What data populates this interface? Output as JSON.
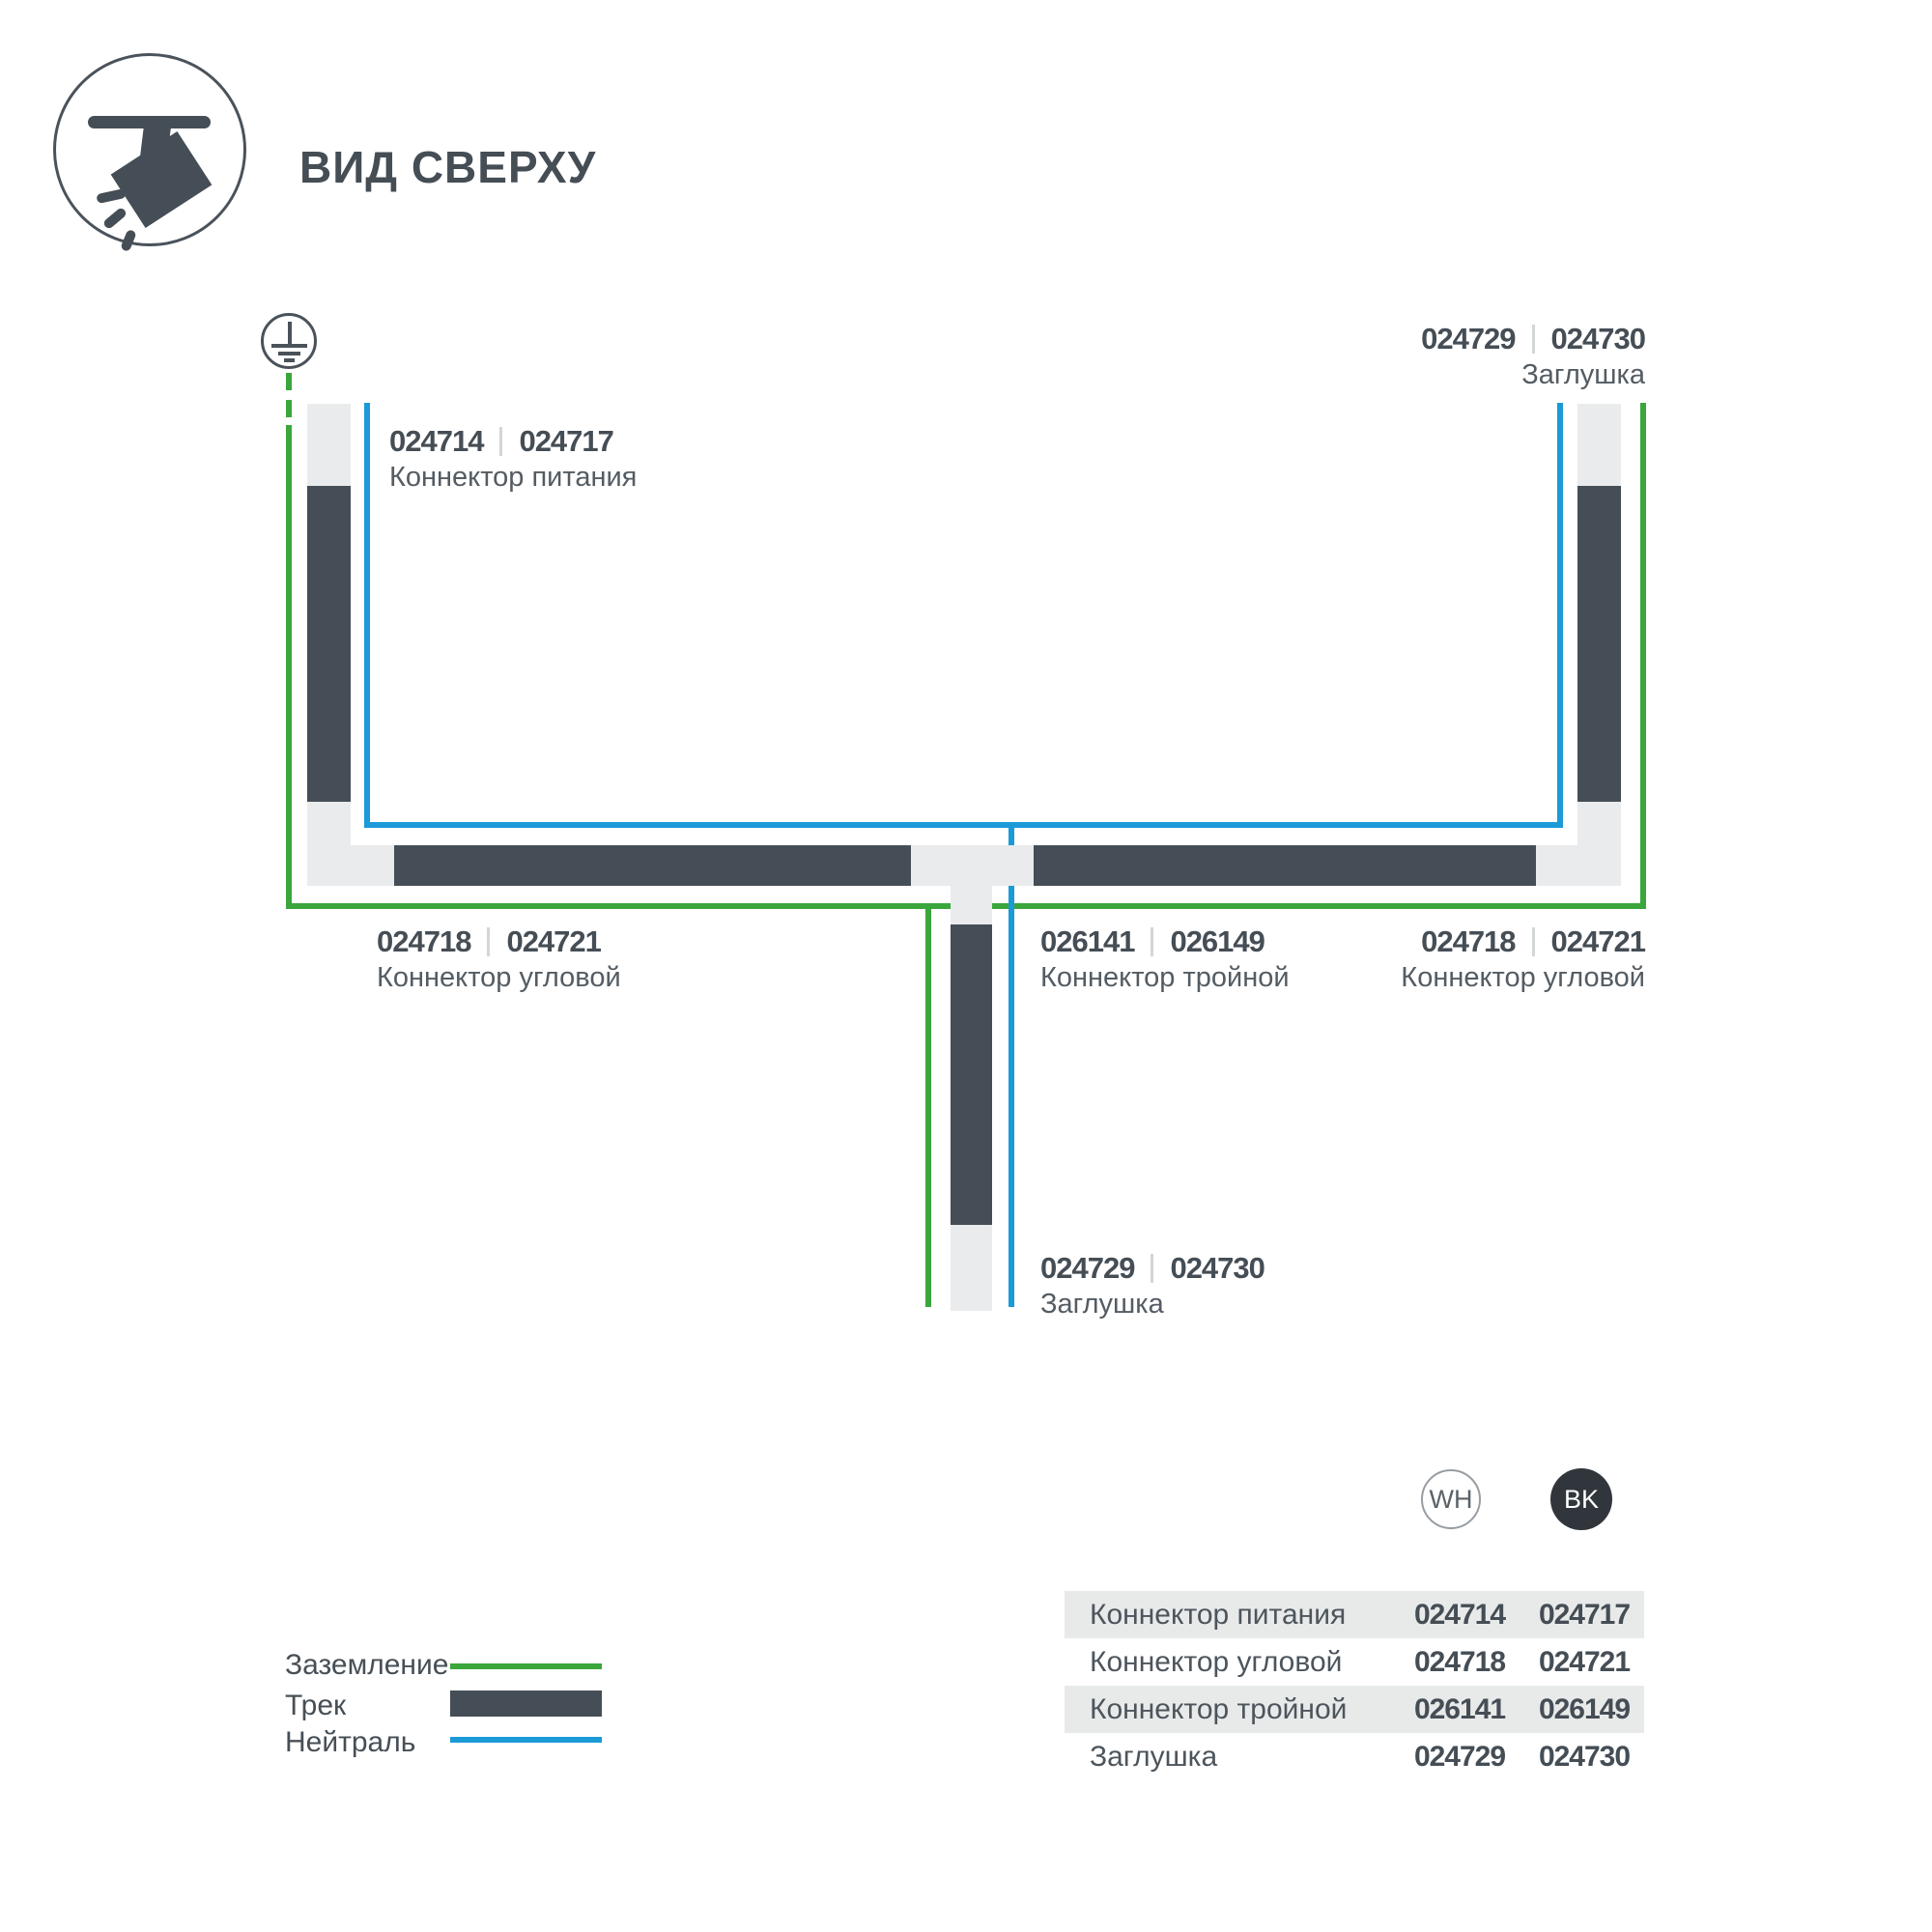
{
  "header": {
    "title": "ВИД СВЕРХУ",
    "icon": "track-spotlight-icon"
  },
  "colors": {
    "track": "#454e56",
    "connector": "#e9ebec",
    "ground_wire": "#3aa63c",
    "neutral_wire": "#1b9ad7",
    "text_primary": "#454d55",
    "text_secondary": "#545c63",
    "table_row_alt": "#e8eaea",
    "bk_badge": "#30363b"
  },
  "diagram": {
    "ground_icon": "earth-ground-symbol",
    "labels": {
      "power": {
        "wh": "024714",
        "bk": "024717",
        "name": "Коннектор питания"
      },
      "endcap_top_right": {
        "wh": "024729",
        "bk": "024730",
        "name": "Заглушка"
      },
      "corner_left": {
        "wh": "024718",
        "bk": "024721",
        "name": "Коннектор угловой"
      },
      "tee_center": {
        "wh": "026141",
        "bk": "026149",
        "name": "Коннектор тройной"
      },
      "corner_right": {
        "wh": "024718",
        "bk": "024721",
        "name": "Коннектор угловой"
      },
      "endcap_bottom": {
        "wh": "024729",
        "bk": "024730",
        "name": "Заглушка"
      }
    }
  },
  "legend": {
    "items": [
      {
        "label": "Заземление",
        "swatch": "green-line"
      },
      {
        "label": "Трек",
        "swatch": "dark-bar"
      },
      {
        "label": "Нейтраль",
        "swatch": "blue-line"
      }
    ]
  },
  "table": {
    "columns": [
      {
        "label": "WH"
      },
      {
        "label": "BK"
      }
    ],
    "rows": [
      {
        "name": "Коннектор питания",
        "wh": "024714",
        "bk": "024717"
      },
      {
        "name": "Коннектор угловой",
        "wh": "024718",
        "bk": "024721"
      },
      {
        "name": "Коннектор тройной",
        "wh": "026141",
        "bk": "026149"
      },
      {
        "name": "Заглушка",
        "wh": "024729",
        "bk": "024730"
      }
    ]
  }
}
